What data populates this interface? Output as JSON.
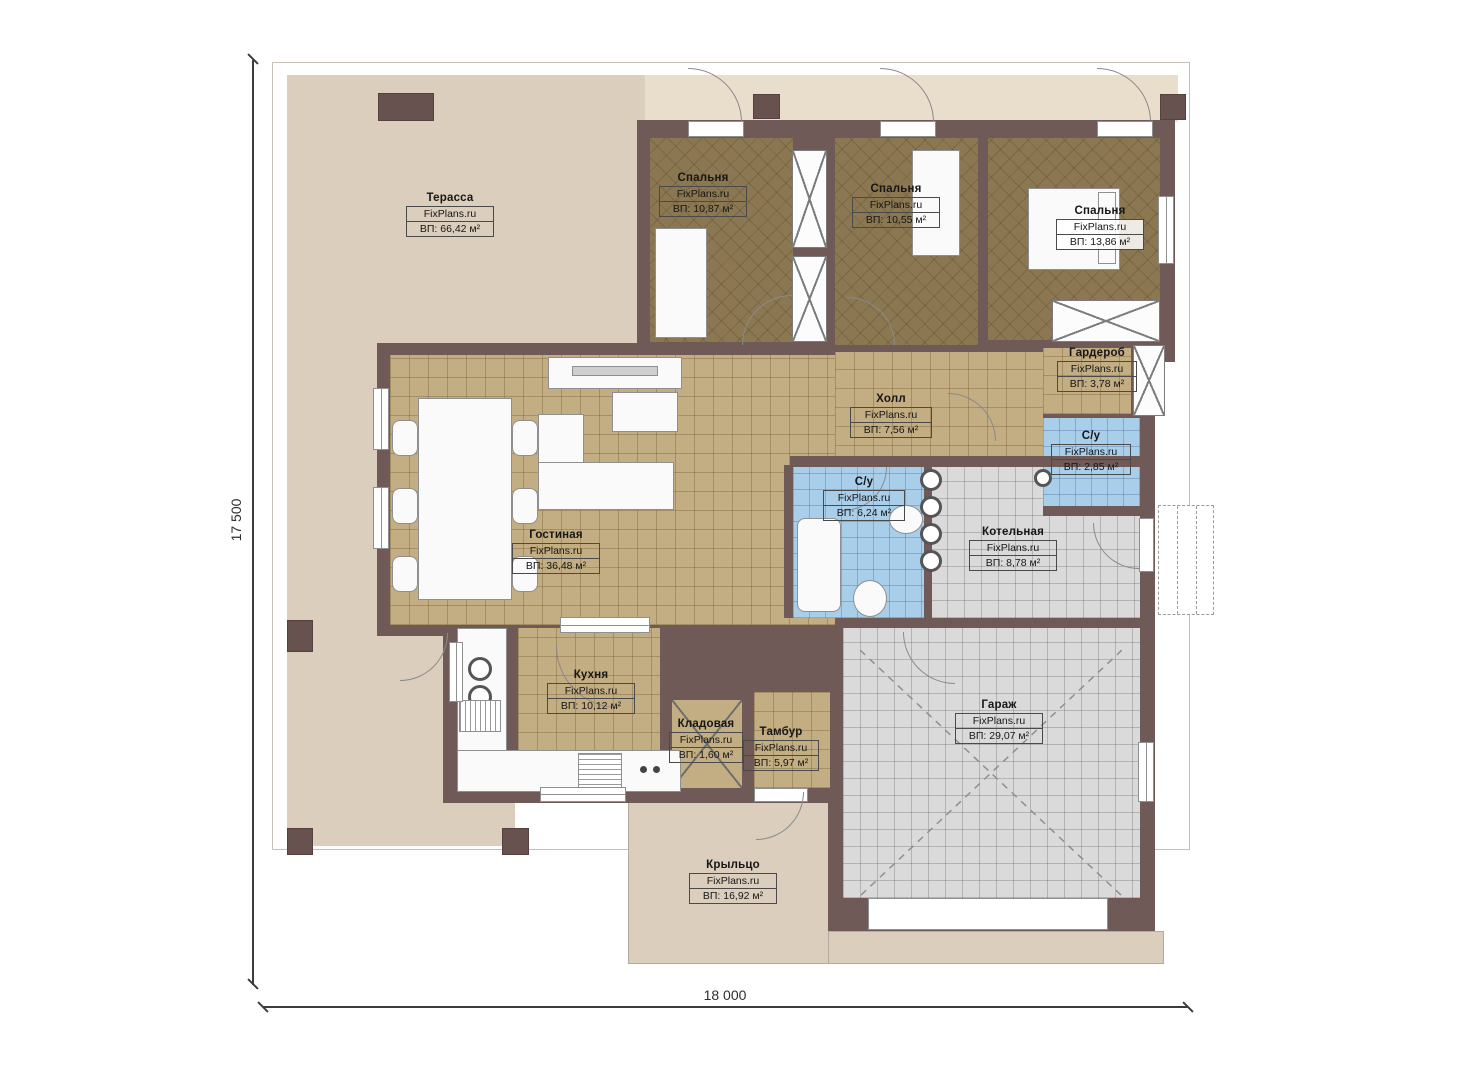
{
  "title": "План одноэтажного дома",
  "watermark": "FixPlans.ru",
  "dimensions": {
    "width_label": "18 000",
    "height_label": "17 500"
  },
  "rooms": [
    {
      "name": "Терасса",
      "area": "ВП: 66,42 м²"
    },
    {
      "name": "Спальня",
      "area": "ВП: 10,87 м²"
    },
    {
      "name": "Спальня",
      "area": "ВП: 10,55 м²"
    },
    {
      "name": "Спальня",
      "area": "ВП: 13,86 м²"
    },
    {
      "name": "Гардероб",
      "area": "ВП: 3,78 м²"
    },
    {
      "name": "С/у",
      "area": "ВП: 2,85 м²"
    },
    {
      "name": "Холл",
      "area": "ВП: 7,56 м²"
    },
    {
      "name": "С/у",
      "area": "ВП: 6,24 м²"
    },
    {
      "name": "Котельная",
      "area": "ВП: 8,78 м²"
    },
    {
      "name": "Гостиная",
      "area": "ВП: 36,48 м²"
    },
    {
      "name": "Кухня",
      "area": "ВП: 10,12 м²"
    },
    {
      "name": "Кладовая",
      "area": "ВП: 1,60 м²"
    },
    {
      "name": "Тамбур",
      "area": "ВП: 5,97 м²"
    },
    {
      "name": "Гараж",
      "area": "ВП: 29,07 м²"
    },
    {
      "name": "Крыльцо",
      "area": "ВП: 16,92 м²"
    }
  ],
  "colors": {
    "wall": "#6f5a58",
    "terrace": "#dbcebc",
    "bedroom_floor": "#8b7751",
    "tile_tan": "#c3ad82",
    "tile_blue": "#a9cee9",
    "tile_gray": "#dadada"
  }
}
